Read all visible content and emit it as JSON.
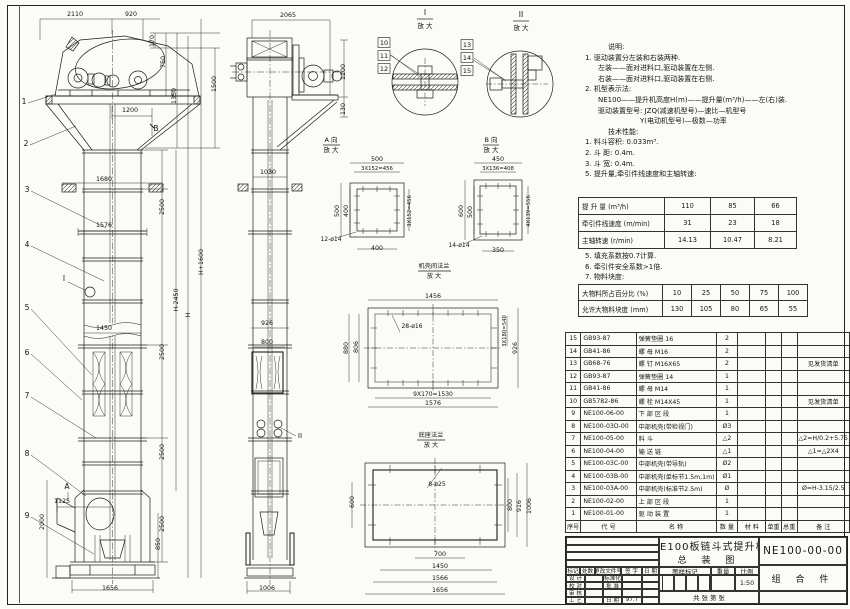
{
  "sheet_title": "NE100板链斗式提升机 总装图",
  "notes1": [
    {
      "c": "nh",
      "t": "说明:"
    },
    {
      "c": "nn",
      "t": "1. 驱动装置分左装和右装两种."
    },
    {
      "c": "nc",
      "t": "左装——面对进料口,驱动装置在左侧."
    },
    {
      "c": "nc",
      "t": "右装——面对进料口,驱动装置在右侧."
    },
    {
      "c": "nn",
      "t": "2. 机型表示法:"
    },
    {
      "c": "nc",
      "t": "NE100——提升机高度H(m)——提升量(m³/h)——左(右)装."
    },
    {
      "c": "nc",
      "t": "驱动装置型号: JZQ(减速机型号)—速比—机型号"
    },
    {
      "c": "ncc",
      "t": "Y(电动机型号)—极数—功率"
    },
    {
      "c": "nh",
      "t": "技术性能:"
    },
    {
      "c": "nn",
      "t": "1. 料斗容积: 0.033m³."
    },
    {
      "c": "nn",
      "t": "2. 斗  距: 0.4m."
    },
    {
      "c": "nn",
      "t": "3. 斗  宽: 0.4m."
    },
    {
      "c": "nn",
      "t": "5. 提升量,牵引件线速度和主轴转速:"
    }
  ],
  "speed_table": {
    "rows": [
      {
        "label": "提 升 量  (m³/h)",
        "values": [
          "110",
          "85",
          "66"
        ]
      },
      {
        "label": "牵引件线速度 (m/min)",
        "values": [
          "31",
          "23",
          "18"
        ]
      },
      {
        "label": "主轴转速 (r/min)",
        "values": [
          "14.13",
          "10.47",
          "8.21"
        ]
      }
    ]
  },
  "notes2": [
    {
      "c": "nn",
      "t": "5. 填充系数按0.7计算."
    },
    {
      "c": "nn",
      "t": "6. 牵引件安全系数>1倍."
    },
    {
      "c": "nn",
      "t": "7. 物料块度:"
    }
  ],
  "lump_table": {
    "rows": [
      {
        "label": "大物料所占百分比 (%)",
        "values": [
          "10",
          "25",
          "50",
          "75",
          "100"
        ]
      },
      {
        "label": "允许大物料块度 (mm)",
        "values": [
          "130",
          "105",
          "80",
          "65",
          "55"
        ]
      }
    ]
  },
  "bom": {
    "headers": [
      "序号",
      "代  号",
      "名     称",
      "数 量",
      "材   料",
      "单重",
      "总重",
      "备  注"
    ],
    "rows": [
      [
        "15",
        "GB93-87",
        "弹簧垫圈 16",
        "2",
        "",
        "",
        "",
        ""
      ],
      [
        "14",
        "GB41-86",
        "螺  母  M16",
        "2",
        "",
        "",
        "",
        ""
      ],
      [
        "13",
        "GB68-76",
        "螺  钉  M16X65",
        "2",
        "",
        "",
        "",
        "见发货清单"
      ],
      [
        "12",
        "GB93-87",
        "弹簧垫圈 14",
        "1",
        "",
        "",
        "",
        ""
      ],
      [
        "11",
        "GB41-86",
        "螺  母  M14",
        "1",
        "",
        "",
        "",
        ""
      ],
      [
        "10",
        "GB5782-86",
        "螺  栓  M14X45",
        "1",
        "",
        "",
        "",
        "见发货清单"
      ],
      [
        "9",
        "NE100-06-00",
        "下 部 区 段",
        "1",
        "",
        "",
        "",
        ""
      ],
      [
        "8",
        "NE100-03D-00",
        "中部机壳(带检视门)",
        "Ø3",
        "",
        "",
        "",
        ""
      ],
      [
        "7",
        "NE100-05-00",
        "料  斗",
        "△2",
        "",
        "",
        "",
        "△2=H/0.2+5.75"
      ],
      [
        "6",
        "NE100-04-00",
        "输 送 链",
        "△1",
        "",
        "",
        "",
        "△1=△2X4"
      ],
      [
        "5",
        "NE100-03C-00",
        "中部机壳(带导轨)",
        "Ø2",
        "",
        "",
        "",
        ""
      ],
      [
        "4",
        "NE100-03B-00",
        "中部机壳(单标节1.5m,1m)",
        "Ø1",
        "",
        "",
        "",
        ""
      ],
      [
        "3",
        "NE100-03A-00",
        "中部机壳(标准节2.5m)",
        "Ø",
        "",
        "",
        "",
        "Ø=H-3.15/2.5"
      ],
      [
        "2",
        "NE100-02-00",
        "上 部 区 段",
        "1",
        "",
        "",
        "",
        ""
      ],
      [
        "1",
        "NE100-01-00",
        "驱 动 装 置",
        "1",
        "",
        "",
        "",
        ""
      ]
    ]
  },
  "title_block": {
    "title_line1": "NE100板链斗式提升机",
    "title_line2": "总 装 图",
    "drawing_no": "NE100-00-00",
    "part_type": "组 合 件",
    "change_header": [
      "标记",
      "处数",
      "更改文件号",
      "签 字",
      "日 期"
    ],
    "sig_rows": [
      [
        "设 计",
        "",
        "标准化",
        "",
        ""
      ],
      [
        "校 对",
        "",
        "批 准",
        "",
        ""
      ],
      [
        "审 核",
        "",
        "",
        "",
        ""
      ],
      [
        "工 艺",
        "",
        "日 期",
        "97.7",
        ""
      ]
    ],
    "stamp_label": "图样标记",
    "weight_label": "重量",
    "scale_label": "比例",
    "scale_value": "1:50",
    "sheets_line": "共    张   第    张"
  },
  "drawing": {
    "labels": [
      {
        "t": "2110",
        "x": 75,
        "y": 16
      },
      {
        "t": "920",
        "x": 131,
        "y": 16
      },
      {
        "t": "170",
        "x": 154,
        "y": 41,
        "r": -90
      },
      {
        "t": "750",
        "x": 165,
        "y": 62,
        "r": -90
      },
      {
        "t": "1350",
        "x": 176,
        "y": 96,
        "r": -90
      },
      {
        "t": "1500",
        "x": 216,
        "y": 84,
        "r": -90
      },
      {
        "t": "1200",
        "x": 130,
        "y": 112
      },
      {
        "t": "B",
        "x": 156,
        "y": 131,
        "fs": 7.5
      },
      {
        "t": "1680",
        "x": 104,
        "y": 181
      },
      {
        "t": "1576",
        "x": 104,
        "y": 227
      },
      {
        "t": "1450",
        "x": 104,
        "y": 330
      },
      {
        "t": "2500",
        "x": 164,
        "y": 207,
        "r": -90
      },
      {
        "t": "2500",
        "x": 164,
        "y": 352,
        "r": -90
      },
      {
        "t": "2500",
        "x": 164,
        "y": 452,
        "r": -90
      },
      {
        "t": "2500",
        "x": 164,
        "y": 524,
        "r": -90
      },
      {
        "t": "H-2450",
        "x": 178,
        "y": 300,
        "r": -90
      },
      {
        "t": "H",
        "x": 190,
        "y": 315,
        "r": -90
      },
      {
        "t": "H+1600",
        "x": 203,
        "y": 262,
        "r": -90
      },
      {
        "t": "1125",
        "x": 62,
        "y": 503
      },
      {
        "t": "A",
        "x": 67,
        "y": 489,
        "fs": 7.5
      },
      {
        "t": "2000",
        "x": 44,
        "y": 522,
        "r": -90
      },
      {
        "t": "850",
        "x": 160,
        "y": 544,
        "r": -90
      },
      {
        "t": "1656",
        "x": 110,
        "y": 590
      },
      {
        "t": "I",
        "x": 64,
        "y": 281,
        "fs": 7.5
      },
      {
        "t": "1",
        "x": 24,
        "y": 104,
        "fs": 7.5
      },
      {
        "t": "2",
        "x": 26,
        "y": 146,
        "fs": 7.5
      },
      {
        "t": "3",
        "x": 27,
        "y": 192,
        "fs": 7.5
      },
      {
        "t": "4",
        "x": 27,
        "y": 247,
        "fs": 7.5
      },
      {
        "t": "5",
        "x": 27,
        "y": 310,
        "fs": 7.5
      },
      {
        "t": "6",
        "x": 27,
        "y": 355,
        "fs": 7.5
      },
      {
        "t": "7",
        "x": 27,
        "y": 398,
        "fs": 7.5
      },
      {
        "t": "8",
        "x": 27,
        "y": 456,
        "fs": 7.5
      },
      {
        "t": "9",
        "x": 27,
        "y": 518,
        "fs": 7.5
      },
      {
        "t": "2065",
        "x": 288,
        "y": 17
      },
      {
        "t": "1200",
        "x": 345,
        "y": 72,
        "r": -90
      },
      {
        "t": "130",
        "x": 345,
        "y": 109,
        "r": -90
      },
      {
        "t": "1030",
        "x": 268,
        "y": 174
      },
      {
        "t": "926",
        "x": 267,
        "y": 325
      },
      {
        "t": "800",
        "x": 267,
        "y": 344
      },
      {
        "t": "1006",
        "x": 267,
        "y": 590
      },
      {
        "t": "II",
        "x": 300,
        "y": 438,
        "fs": 7
      },
      {
        "t": "10",
        "x": 384,
        "y": 45,
        "fs": 6.5,
        "box": 1
      },
      {
        "t": "11",
        "x": 384,
        "y": 58,
        "fs": 6.5,
        "box": 1
      },
      {
        "t": "12",
        "x": 384,
        "y": 71,
        "fs": 6.5,
        "box": 1
      },
      {
        "t": "13",
        "x": 467,
        "y": 47,
        "fs": 6.5,
        "box": 1
      },
      {
        "t": "14",
        "x": 467,
        "y": 60,
        "fs": 6.5,
        "box": 1
      },
      {
        "t": "15",
        "x": 467,
        "y": 73,
        "fs": 6.5,
        "box": 1
      },
      {
        "t": "I",
        "x": 425,
        "y": 15,
        "fs": 7.5
      },
      {
        "t": "放 大",
        "x": 425,
        "y": 28,
        "fs": 6.5
      },
      {
        "t": "II",
        "x": 521,
        "y": 17,
        "fs": 7.5
      },
      {
        "t": "放 大",
        "x": 521,
        "y": 30,
        "fs": 6.5
      },
      {
        "t": "A 向",
        "x": 331,
        "y": 142,
        "fs": 6.5
      },
      {
        "t": "放 大",
        "x": 331,
        "y": 152,
        "fs": 6.5
      },
      {
        "t": "B 向",
        "x": 491,
        "y": 142,
        "fs": 6.5
      },
      {
        "t": "放 大",
        "x": 491,
        "y": 152,
        "fs": 6.5
      },
      {
        "t": "机壳间法兰",
        "x": 434,
        "y": 268,
        "fs": 6.2
      },
      {
        "t": "放 大",
        "x": 434,
        "y": 278,
        "fs": 6.2
      },
      {
        "t": "底座法兰",
        "x": 431,
        "y": 437,
        "fs": 6.2
      },
      {
        "t": "放 大",
        "x": 431,
        "y": 447,
        "fs": 6.2
      },
      {
        "t": "500",
        "x": 377,
        "y": 161
      },
      {
        "t": "3X152=456",
        "x": 377,
        "y": 170,
        "fs": 5.3
      },
      {
        "t": "500",
        "x": 339,
        "y": 211,
        "r": -90
      },
      {
        "t": "400",
        "x": 348,
        "y": 211,
        "r": -90
      },
      {
        "t": "400",
        "x": 377,
        "y": 250
      },
      {
        "t": "3X152=456",
        "x": 411,
        "y": 211,
        "r": -90,
        "fs": 5.3
      },
      {
        "t": "12-ø14",
        "x": 331,
        "y": 241,
        "fs": 6
      },
      {
        "t": "450",
        "x": 498,
        "y": 161
      },
      {
        "t": "3X136=408",
        "x": 498,
        "y": 170,
        "fs": 5.3
      },
      {
        "t": "600",
        "x": 463,
        "y": 211,
        "r": -90
      },
      {
        "t": "500",
        "x": 472,
        "y": 212,
        "r": -90
      },
      {
        "t": "4X139=556",
        "x": 530,
        "y": 211,
        "r": -90,
        "fs": 5.3
      },
      {
        "t": "350",
        "x": 498,
        "y": 252
      },
      {
        "t": "14-ø14",
        "x": 459,
        "y": 247,
        "fs": 6
      },
      {
        "t": "1456",
        "x": 433,
        "y": 298
      },
      {
        "t": "28-ø16",
        "x": 412,
        "y": 328,
        "fs": 6
      },
      {
        "t": "880",
        "x": 348,
        "y": 348,
        "r": -90
      },
      {
        "t": "806",
        "x": 358,
        "y": 347,
        "r": -90
      },
      {
        "t": "3X180=540",
        "x": 506,
        "y": 331,
        "r": -90,
        "fs": 5.3
      },
      {
        "t": "926",
        "x": 517,
        "y": 348,
        "r": -90
      },
      {
        "t": "9X170=1530",
        "x": 433,
        "y": 396,
        "fs": 6
      },
      {
        "t": "1576",
        "x": 433,
        "y": 405
      },
      {
        "t": "8-ø25",
        "x": 437,
        "y": 486,
        "fs": 6
      },
      {
        "t": "600",
        "x": 354,
        "y": 502,
        "r": -90
      },
      {
        "t": "800",
        "x": 512,
        "y": 505,
        "r": -90
      },
      {
        "t": "916",
        "x": 521,
        "y": 506,
        "r": -90
      },
      {
        "t": "1006",
        "x": 531,
        "y": 506,
        "r": -90
      },
      {
        "t": "700",
        "x": 440,
        "y": 556
      },
      {
        "t": "1450",
        "x": 440,
        "y": 568
      },
      {
        "t": "1566",
        "x": 440,
        "y": 580
      },
      {
        "t": "1656",
        "x": 440,
        "y": 592
      }
    ]
  }
}
